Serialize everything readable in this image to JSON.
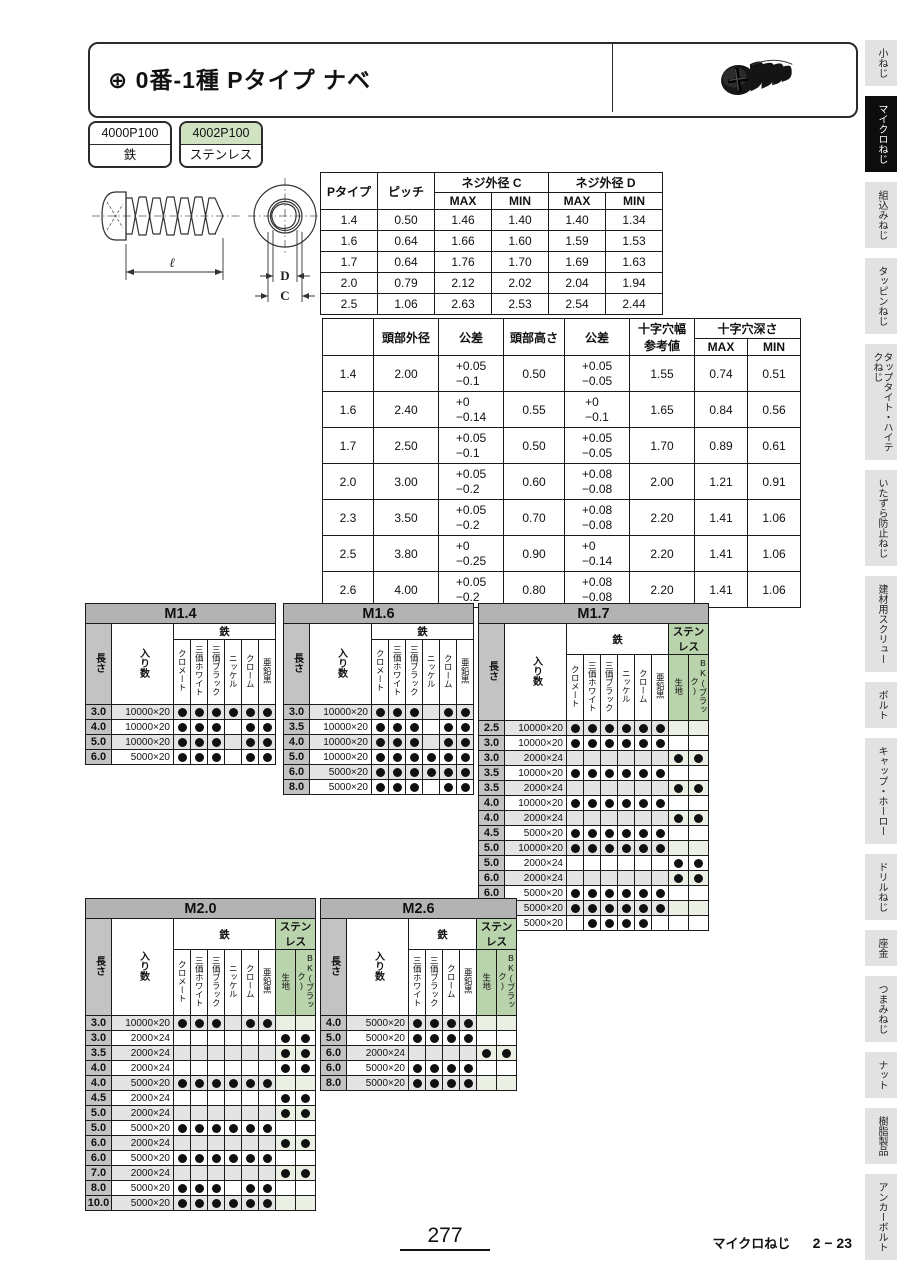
{
  "page": {
    "number": "277",
    "footer_section": "マイクロねじ",
    "footer_page": "2 − 23"
  },
  "header": {
    "title": "⊕ 0番-1種 Pタイプ ナベ",
    "image": "black-pan-head-phillips-screw"
  },
  "product_codes": [
    {
      "code": "4000P100",
      "material": "鉄",
      "highlight": false
    },
    {
      "code": "4002P100",
      "material": "ステンレス",
      "highlight": true
    }
  ],
  "diagram": {
    "length_label": "ℓ",
    "d_label": "D",
    "c_label": "C"
  },
  "spec_table_1": {
    "col_type": "Pタイプ",
    "col_pitch": "ピッチ",
    "group_c": "ネジ外径 C",
    "group_d": "ネジ外径 D",
    "max": "MAX",
    "min": "MIN",
    "rows": [
      [
        "1.4",
        "0.50",
        "1.46",
        "1.40",
        "1.40",
        "1.34"
      ],
      [
        "1.6",
        "0.64",
        "1.66",
        "1.60",
        "1.59",
        "1.53"
      ],
      [
        "1.7",
        "0.64",
        "1.76",
        "1.70",
        "1.69",
        "1.63"
      ],
      [
        "2.0",
        "0.79",
        "2.12",
        "2.02",
        "2.04",
        "1.94"
      ],
      [
        "2.5",
        "1.06",
        "2.63",
        "2.53",
        "2.54",
        "2.44"
      ]
    ]
  },
  "spec_table_2": {
    "headers": {
      "head_dia": "頭部外径",
      "tol1": "公差",
      "head_height": "頭部高さ",
      "tol2": "公差",
      "cross_width_line1": "十字穴幅",
      "cross_width_line2": "参考値",
      "cross_depth": "十字穴深さ",
      "max": "MAX",
      "min": "MIN"
    },
    "rows": [
      {
        "size": "1.4",
        "head_dia": "2.00",
        "tol1": [
          "+0.05",
          "−0.1"
        ],
        "head_height": "0.50",
        "tol2": [
          "+0.05",
          "−0.05"
        ],
        "cross_width": "1.55",
        "depth_max": "0.74",
        "depth_min": "0.51"
      },
      {
        "size": "1.6",
        "head_dia": "2.40",
        "tol1": [
          "+0",
          "−0.14"
        ],
        "head_height": "0.55",
        "tol2": [
          "+0",
          "−0.1"
        ],
        "cross_width": "1.65",
        "depth_max": "0.84",
        "depth_min": "0.56"
      },
      {
        "size": "1.7",
        "head_dia": "2.50",
        "tol1": [
          "+0.05",
          "−0.1"
        ],
        "head_height": "0.50",
        "tol2": [
          "+0.05",
          "−0.05"
        ],
        "cross_width": "1.70",
        "depth_max": "0.89",
        "depth_min": "0.61"
      },
      {
        "size": "2.0",
        "head_dia": "3.00",
        "tol1": [
          "+0.05",
          "−0.2"
        ],
        "head_height": "0.60",
        "tol2": [
          "+0.08",
          "−0.08"
        ],
        "cross_width": "2.00",
        "depth_max": "1.21",
        "depth_min": "0.91"
      },
      {
        "size": "2.3",
        "head_dia": "3.50",
        "tol1": [
          "+0.05",
          "−0.2"
        ],
        "head_height": "0.70",
        "tol2": [
          "+0.08",
          "−0.08"
        ],
        "cross_width": "2.20",
        "depth_max": "1.41",
        "depth_min": "1.06"
      },
      {
        "size": "2.5",
        "head_dia": "3.80",
        "tol1": [
          "+0",
          "−0.25"
        ],
        "head_height": "0.90",
        "tol2": [
          "+0",
          "−0.14"
        ],
        "cross_width": "2.20",
        "depth_max": "1.41",
        "depth_min": "1.06"
      },
      {
        "size": "2.6",
        "head_dia": "4.00",
        "tol1": [
          "+0.05",
          "−0.2"
        ],
        "head_height": "0.80",
        "tol2": [
          "+0.08",
          "−0.08"
        ],
        "cross_width": "2.20",
        "depth_max": "1.41",
        "depth_min": "1.06"
      }
    ]
  },
  "size_table_labels": {
    "length": "長さ",
    "qty": "入り数",
    "iron": "鉄",
    "stainless": "ステンレス"
  },
  "size_tables": [
    {
      "title": "M1.4",
      "iron_columns": [
        "クロメート",
        "三価ホワイト",
        "三価ブラック",
        "ニッケル",
        "クローム",
        "亜鉛黒"
      ],
      "stainless_columns": [],
      "rows": [
        {
          "length": "3.0",
          "qty": "10000×20",
          "iron": [
            1,
            1,
            1,
            1,
            1,
            1
          ],
          "stainless": []
        },
        {
          "length": "4.0",
          "qty": "10000×20",
          "iron": [
            1,
            1,
            1,
            0,
            1,
            1
          ],
          "stainless": []
        },
        {
          "length": "5.0",
          "qty": "10000×20",
          "iron": [
            1,
            1,
            1,
            0,
            1,
            1
          ],
          "stainless": []
        },
        {
          "length": "6.0",
          "qty": "5000×20",
          "iron": [
            1,
            1,
            1,
            0,
            1,
            1
          ],
          "stainless": []
        }
      ]
    },
    {
      "title": "M1.6",
      "iron_columns": [
        "クロメート",
        "三価ホワイト",
        "三価ブラック",
        "ニッケル",
        "クローム",
        "亜鉛黒"
      ],
      "stainless_columns": [],
      "rows": [
        {
          "length": "3.0",
          "qty": "10000×20",
          "iron": [
            1,
            1,
            1,
            0,
            1,
            1
          ],
          "stainless": []
        },
        {
          "length": "3.5",
          "qty": "10000×20",
          "iron": [
            1,
            1,
            1,
            0,
            1,
            1
          ],
          "stainless": []
        },
        {
          "length": "4.0",
          "qty": "10000×20",
          "iron": [
            1,
            1,
            1,
            0,
            1,
            1
          ],
          "stainless": []
        },
        {
          "length": "5.0",
          "qty": "10000×20",
          "iron": [
            1,
            1,
            1,
            1,
            1,
            1
          ],
          "stainless": []
        },
        {
          "length": "6.0",
          "qty": "5000×20",
          "iron": [
            1,
            1,
            1,
            1,
            1,
            1
          ],
          "stainless": []
        },
        {
          "length": "8.0",
          "qty": "5000×20",
          "iron": [
            1,
            1,
            1,
            0,
            1,
            1
          ],
          "stainless": []
        }
      ]
    },
    {
      "title": "M1.7",
      "iron_columns": [
        "クロメート",
        "三価ホワイト",
        "三価ブラック",
        "ニッケル",
        "クローム",
        "亜鉛黒"
      ],
      "stainless_columns": [
        "生地",
        "BK(ブラック)"
      ],
      "rows": [
        {
          "length": "2.5",
          "qty": "10000×20",
          "iron": [
            1,
            1,
            1,
            1,
            1,
            1
          ],
          "stainless": [
            0,
            0
          ]
        },
        {
          "length": "3.0",
          "qty": "10000×20",
          "iron": [
            1,
            1,
            1,
            1,
            1,
            1
          ],
          "stainless": [
            0,
            0
          ]
        },
        {
          "length": "3.0",
          "qty": "2000×24",
          "iron": [
            0,
            0,
            0,
            0,
            0,
            0
          ],
          "stainless": [
            1,
            1
          ]
        },
        {
          "length": "3.5",
          "qty": "10000×20",
          "iron": [
            1,
            1,
            1,
            1,
            1,
            1
          ],
          "stainless": [
            0,
            0
          ]
        },
        {
          "length": "3.5",
          "qty": "2000×24",
          "iron": [
            0,
            0,
            0,
            0,
            0,
            0
          ],
          "stainless": [
            1,
            1
          ]
        },
        {
          "length": "4.0",
          "qty": "10000×20",
          "iron": [
            1,
            1,
            1,
            1,
            1,
            1
          ],
          "stainless": [
            0,
            0
          ]
        },
        {
          "length": "4.0",
          "qty": "2000×24",
          "iron": [
            0,
            0,
            0,
            0,
            0,
            0
          ],
          "stainless": [
            1,
            1
          ]
        },
        {
          "length": "4.5",
          "qty": "5000×20",
          "iron": [
            1,
            1,
            1,
            1,
            1,
            1
          ],
          "stainless": [
            0,
            0
          ]
        },
        {
          "length": "5.0",
          "qty": "10000×20",
          "iron": [
            1,
            1,
            1,
            1,
            1,
            1
          ],
          "stainless": [
            0,
            0
          ]
        },
        {
          "length": "5.0",
          "qty": "2000×24",
          "iron": [
            0,
            0,
            0,
            0,
            0,
            0
          ],
          "stainless": [
            1,
            1
          ]
        },
        {
          "length": "6.0",
          "qty": "2000×24",
          "iron": [
            0,
            0,
            0,
            0,
            0,
            0
          ],
          "stainless": [
            1,
            1
          ]
        },
        {
          "length": "6.0",
          "qty": "5000×20",
          "iron": [
            1,
            1,
            1,
            1,
            1,
            1
          ],
          "stainless": [
            0,
            0
          ]
        },
        {
          "length": "8.0",
          "qty": "5000×20",
          "iron": [
            1,
            1,
            1,
            1,
            1,
            1
          ],
          "stainless": [
            0,
            0
          ]
        },
        {
          "length": "10.0",
          "qty": "5000×20",
          "iron": [
            0,
            1,
            1,
            1,
            1,
            0
          ],
          "stainless": [
            0,
            0
          ]
        }
      ]
    },
    {
      "title": "M2.0",
      "iron_columns": [
        "クロメート",
        "三価ホワイト",
        "三価ブラック",
        "ニッケル",
        "クローム",
        "亜鉛黒"
      ],
      "stainless_columns": [
        "生地",
        "BK(ブラック)"
      ],
      "rows": [
        {
          "length": "3.0",
          "qty": "10000×20",
          "iron": [
            1,
            1,
            1,
            0,
            1,
            1
          ],
          "stainless": [
            0,
            0
          ]
        },
        {
          "length": "3.0",
          "qty": "2000×24",
          "iron": [
            0,
            0,
            0,
            0,
            0,
            0
          ],
          "stainless": [
            1,
            1
          ]
        },
        {
          "length": "3.5",
          "qty": "2000×24",
          "iron": [
            0,
            0,
            0,
            0,
            0,
            0
          ],
          "stainless": [
            1,
            1
          ]
        },
        {
          "length": "4.0",
          "qty": "2000×24",
          "iron": [
            0,
            0,
            0,
            0,
            0,
            0
          ],
          "stainless": [
            1,
            1
          ]
        },
        {
          "length": "4.0",
          "qty": "5000×20",
          "iron": [
            1,
            1,
            1,
            1,
            1,
            1
          ],
          "stainless": [
            0,
            0
          ]
        },
        {
          "length": "4.5",
          "qty": "2000×24",
          "iron": [
            0,
            0,
            0,
            0,
            0,
            0
          ],
          "stainless": [
            1,
            1
          ]
        },
        {
          "length": "5.0",
          "qty": "2000×24",
          "iron": [
            0,
            0,
            0,
            0,
            0,
            0
          ],
          "stainless": [
            1,
            1
          ]
        },
        {
          "length": "5.0",
          "qty": "5000×20",
          "iron": [
            1,
            1,
            1,
            1,
            1,
            1
          ],
          "stainless": [
            0,
            0
          ]
        },
        {
          "length": "6.0",
          "qty": "2000×24",
          "iron": [
            0,
            0,
            0,
            0,
            0,
            0
          ],
          "stainless": [
            1,
            1
          ]
        },
        {
          "length": "6.0",
          "qty": "5000×20",
          "iron": [
            1,
            1,
            1,
            1,
            1,
            1
          ],
          "stainless": [
            0,
            0
          ]
        },
        {
          "length": "7.0",
          "qty": "2000×24",
          "iron": [
            0,
            0,
            0,
            0,
            0,
            0
          ],
          "stainless": [
            1,
            1
          ]
        },
        {
          "length": "8.0",
          "qty": "5000×20",
          "iron": [
            1,
            1,
            1,
            0,
            1,
            1
          ],
          "stainless": [
            0,
            0
          ]
        },
        {
          "length": "10.0",
          "qty": "5000×20",
          "iron": [
            1,
            1,
            1,
            1,
            1,
            1
          ],
          "stainless": [
            0,
            0
          ]
        }
      ]
    },
    {
      "title": "M2.6",
      "iron_columns": [
        "三価ホワイト",
        "三価ブラック",
        "クローム",
        "亜鉛黒"
      ],
      "stainless_columns": [
        "生地",
        "BK(ブラック)"
      ],
      "rows": [
        {
          "length": "4.0",
          "qty": "5000×20",
          "iron": [
            1,
            1,
            1,
            1
          ],
          "stainless": [
            0,
            0
          ]
        },
        {
          "length": "5.0",
          "qty": "5000×20",
          "iron": [
            1,
            1,
            1,
            1
          ],
          "stainless": [
            0,
            0
          ]
        },
        {
          "length": "6.0",
          "qty": "2000×24",
          "iron": [
            0,
            0,
            0,
            0
          ],
          "stainless": [
            1,
            1
          ]
        },
        {
          "length": "6.0",
          "qty": "5000×20",
          "iron": [
            1,
            1,
            1,
            1
          ],
          "stainless": [
            0,
            0
          ]
        },
        {
          "length": "8.0",
          "qty": "5000×20",
          "iron": [
            1,
            1,
            1,
            1
          ],
          "stainless": [
            0,
            0
          ]
        }
      ]
    }
  ],
  "sidebar": {
    "items": [
      {
        "label": "小ねじ",
        "active": false
      },
      {
        "label": "マイクロねじ",
        "active": true
      },
      {
        "label": "組込みねじ",
        "active": false
      },
      {
        "label": "タッピンねじ",
        "active": false
      },
      {
        "label": "タップタイト・ハイテクねじ",
        "active": false
      },
      {
        "label": "いたずら防止ねじ",
        "active": false
      },
      {
        "label": "建材用スクリュー",
        "active": false
      },
      {
        "label": "ボルト",
        "active": false
      },
      {
        "label": "キャップ・ホーロー",
        "active": false
      },
      {
        "label": "ドリルねじ",
        "active": false
      },
      {
        "label": "座金",
        "active": false
      },
      {
        "label": "つまみねじ",
        "active": false
      },
      {
        "label": "ナット",
        "active": false
      },
      {
        "label": "樹脂製品",
        "active": false
      },
      {
        "label": "アンカーボルト",
        "active": false
      }
    ]
  },
  "colors": {
    "green_light": "#cfe3c3",
    "green_hdr": "#b9d3ac",
    "bar_gray": "#b3b3b3",
    "len_gray": "#c3c3c3",
    "tab_gray": "#e2e2e2",
    "dot_black": "#101010"
  }
}
